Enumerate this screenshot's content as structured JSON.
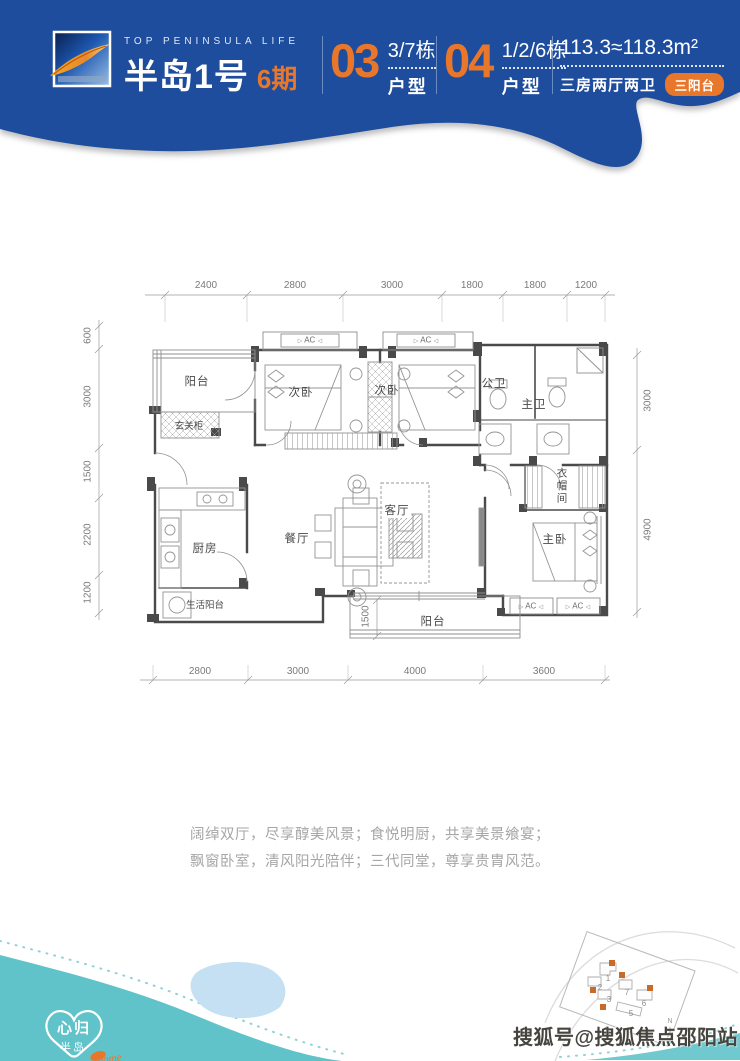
{
  "header": {
    "brand_en": "TOP PENINSULA LIFE",
    "brand_cn": "半岛1号",
    "phase": "6期",
    "units": [
      {
        "number": "03",
        "buildings": "3/7栋",
        "label": "户型"
      },
      {
        "number": "04",
        "buildings": "1/2/6栋",
        "label": "户型"
      }
    ],
    "area": "113.3≈118.3m²",
    "layout": "三房两厅两卫",
    "badge": "三阳台"
  },
  "floorplan": {
    "dims_top": [
      "2400",
      "2800",
      "3000",
      "1800",
      "1800",
      "1200"
    ],
    "dims_bottom": [
      "2800",
      "3000",
      "4000",
      "3600"
    ],
    "dims_left": [
      "600",
      "3000",
      "1500",
      "2200",
      "1200"
    ],
    "dims_right": [
      "3000",
      "4900"
    ],
    "dim_balcony": "1500",
    "ac_label": "AC",
    "rooms": {
      "balcony_top": "阳台",
      "entry_cabinet": "玄关柜",
      "bedroom2a": "次卧",
      "bedroom2b": "次卧",
      "bath_public": "公卫",
      "bath_master": "主卫",
      "kitchen": "厨房",
      "dining": "餐厅",
      "living": "客厅",
      "cloakroom": "衣帽间",
      "master_bedroom": "主卧",
      "utility_balcony": "生活阳台",
      "balcony_bottom": "阳台"
    }
  },
  "tagline": {
    "line1": "阔绰双厅，尽享醇美风景；食悦明厨，共享美景飨宴；",
    "line2": "飘窗卧室，清风阳光陪伴；三代同堂，尊享贵胄风范。"
  },
  "footer": {
    "logo": {
      "line1": "心归",
      "line2": "半岛",
      "script": "home"
    },
    "siteplan": {
      "numbers": [
        "1",
        "2",
        "3",
        "5",
        "6",
        "7"
      ],
      "north": "N"
    },
    "watermark": "搜狐号@搜狐焦点邵阳站"
  },
  "colors": {
    "header_blue": "#1e4d9d",
    "accent_orange": "#e8772b",
    "wave_teal": "#5fc3c9",
    "pond_blue": "#c5e0f2"
  }
}
